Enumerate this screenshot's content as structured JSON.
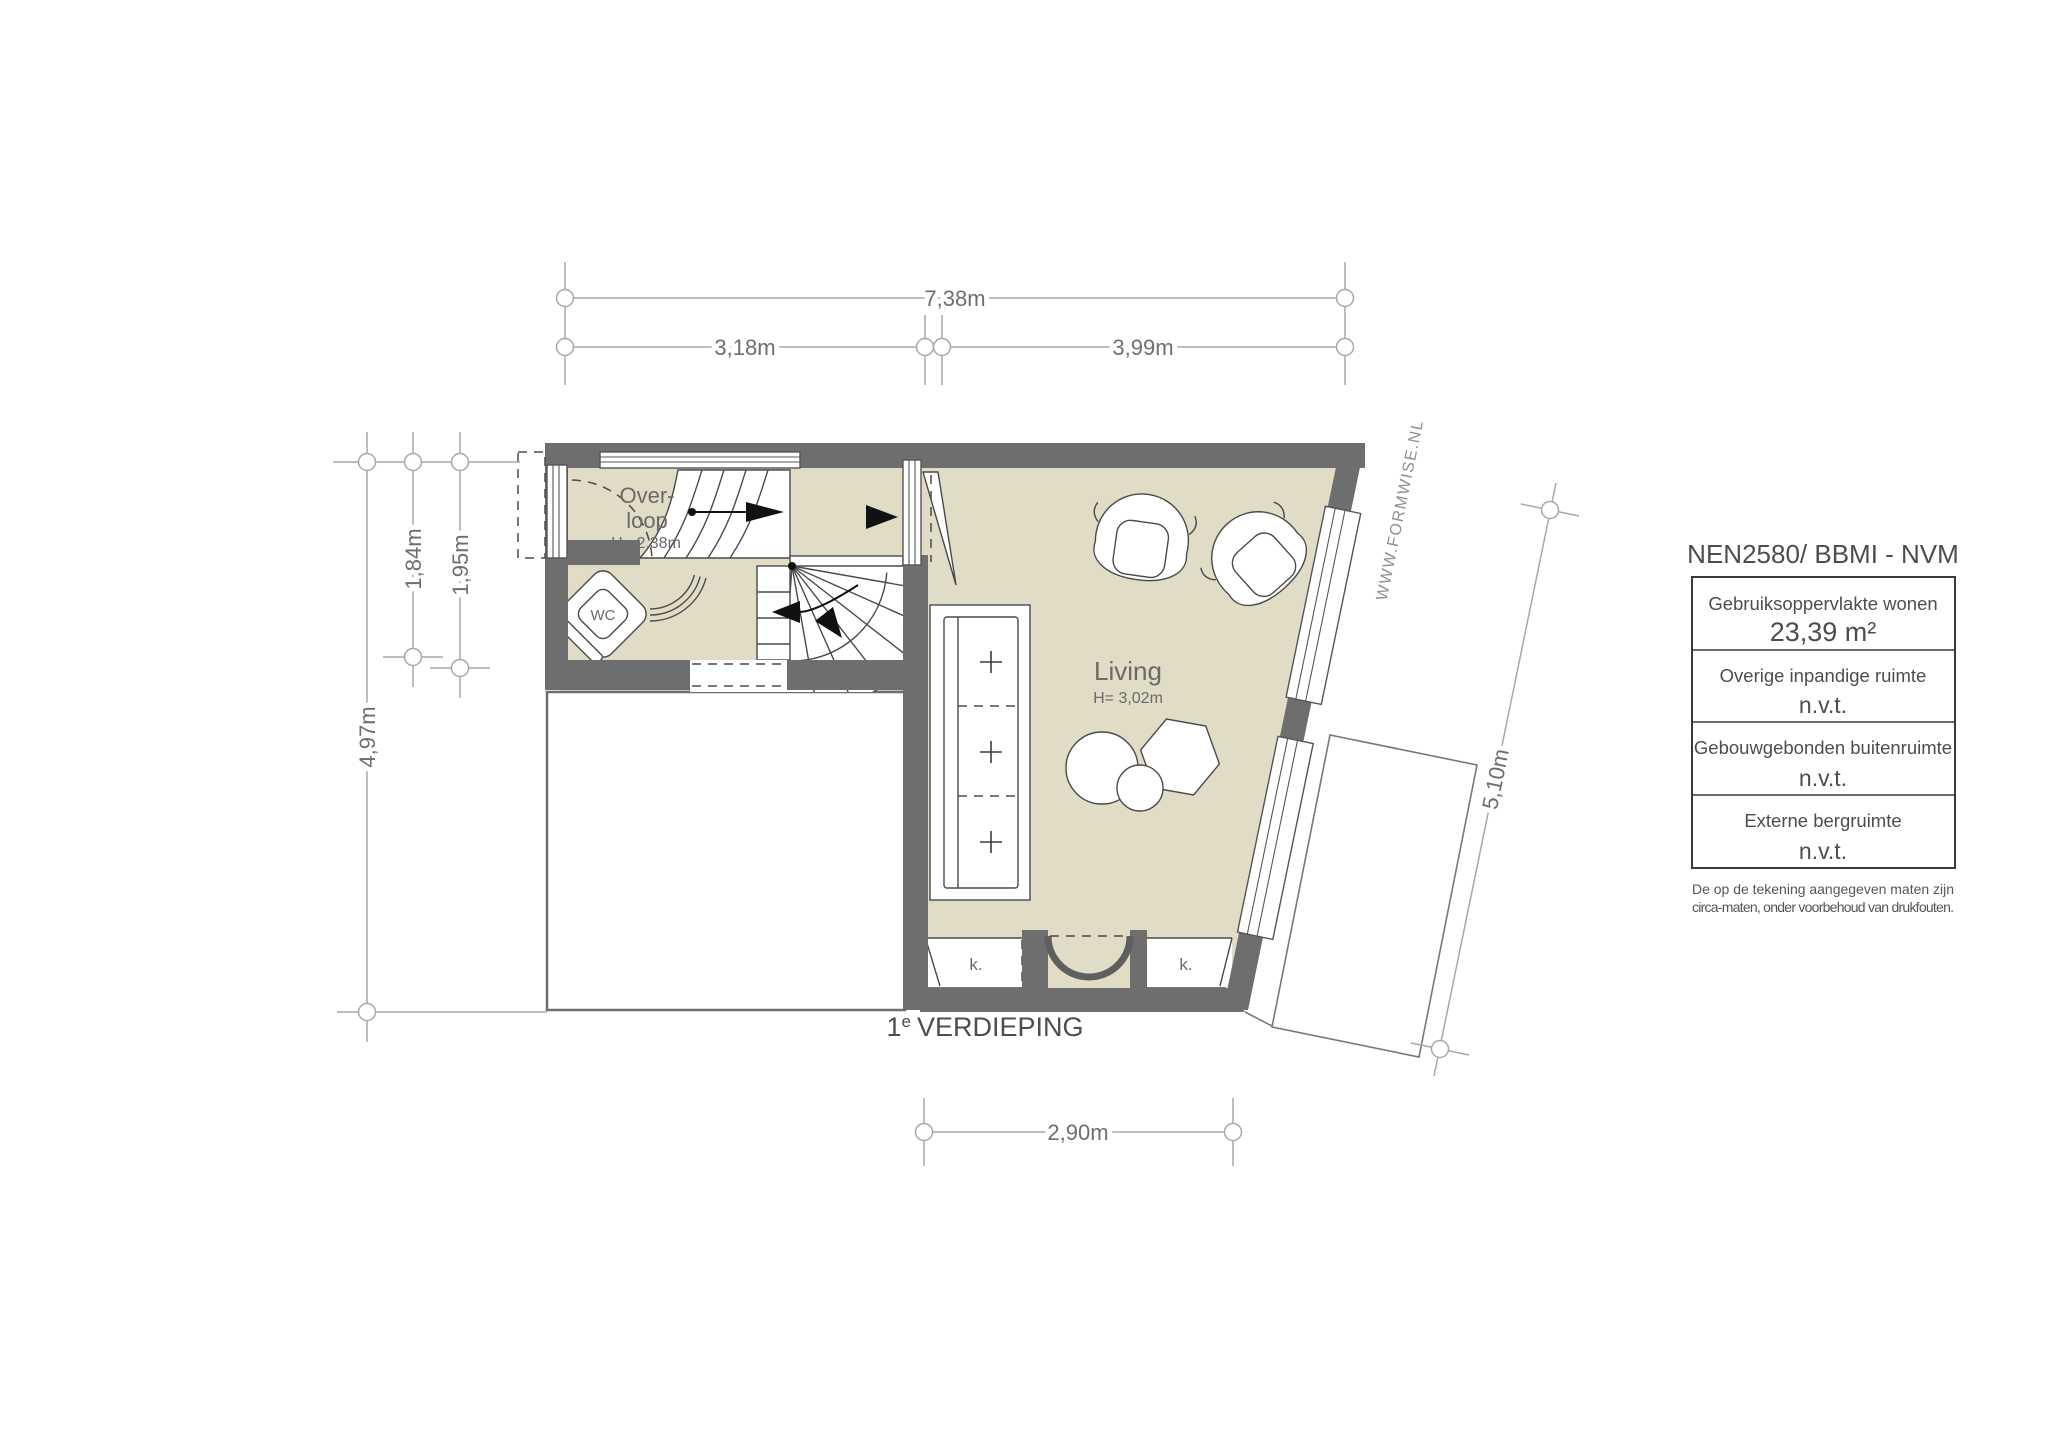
{
  "plan": {
    "floor_title": {
      "num": "1",
      "sup": "e",
      "rest": "VERDIEPING"
    },
    "watermark": "WWW.FORMWISE.NL",
    "rooms": {
      "overloop": {
        "line1": "Over-",
        "line2": "loop",
        "height": "H= 2,38m"
      },
      "living": {
        "name": "Living",
        "height": "H= 3,02m"
      },
      "wc": {
        "name": "WC"
      },
      "closet_left": {
        "name": "k."
      },
      "closet_right": {
        "name": "k."
      }
    },
    "dimensions": {
      "top_total": "7,38m",
      "top_left": "3,18m",
      "top_right": "3,99m",
      "left_outer": "4,97m",
      "left_upper": "1,84m",
      "left_inner": "1,95m",
      "right_side": "5,10m",
      "bottom": "2,90m"
    }
  },
  "legend": {
    "title": "NEN2580/ BBMI - NVM",
    "rows": [
      {
        "label": "Gebruiksoppervlakte wonen",
        "value": "23,39 m²"
      },
      {
        "label": "Overige inpandige ruimte",
        "value": "n.v.t."
      },
      {
        "label": "Gebouwgebonden buitenruimte",
        "value": "n.v.t."
      },
      {
        "label": "Externe bergruimte",
        "value": "n.v.t."
      }
    ],
    "footnote": {
      "line1": "De op de tekening aangegeven maten zijn",
      "line2": "circa-maten, onder voorbehoud van drukfouten."
    }
  },
  "colors": {
    "wall": "#6e6e6e",
    "floor": "#e0dcc5",
    "dim_line": "#a8a8a8",
    "text": "#666666"
  }
}
